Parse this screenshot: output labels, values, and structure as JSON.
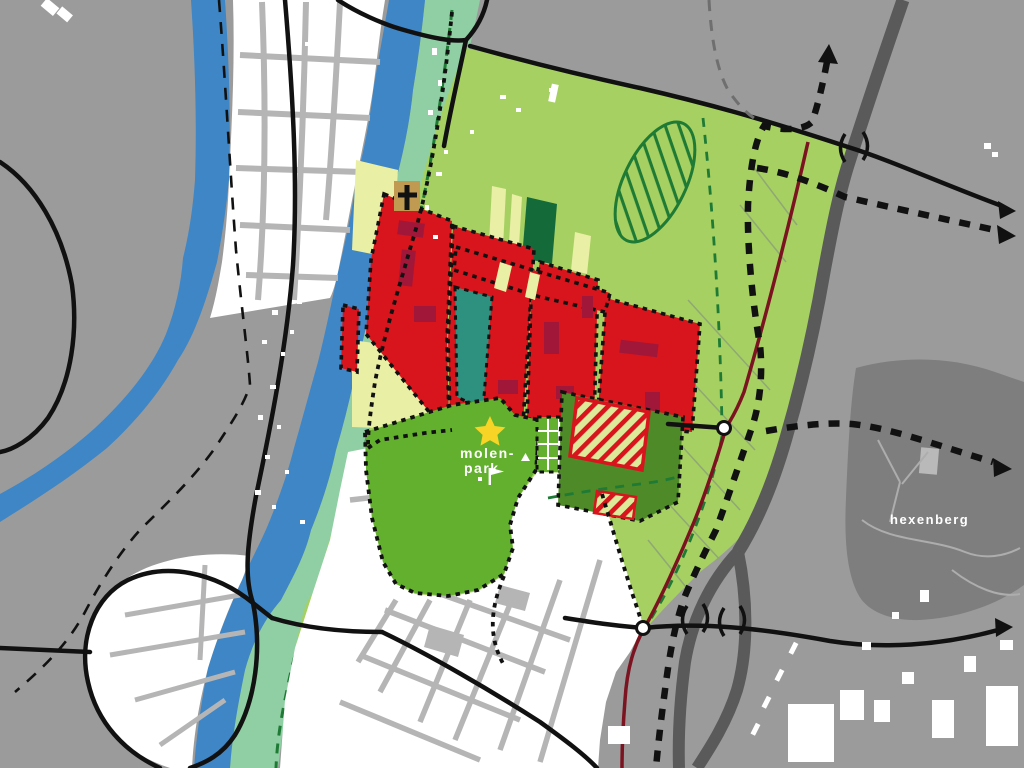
{
  "map": {
    "labels": {
      "park_line1": "molen-",
      "park_line2": "park",
      "hill": "hexenberg"
    },
    "colors": {
      "background": "#9b9b9b",
      "water": "#3e86c6",
      "riverside_band": "#8fcfa3",
      "plan_area": "#a6d061",
      "park": "#63b02e",
      "sports_field": "#4e8a28",
      "forest": "#156a3a",
      "teal_parcel": "#2e9180",
      "pale_field": "#e9efa5",
      "development": "#d8141c",
      "development_dark": "#a0173a",
      "hatch_bg": "#dcea9a",
      "hatch_stripe": "#d8141c",
      "boundary_dots": "#111111",
      "route_dashes": "#111111",
      "green_dashed": "#1e7a34",
      "maroon_road": "#7b1420",
      "highway": "#5a5a5a",
      "road": "#111111",
      "street": "#b5b5b5",
      "buildings": "#ffffff",
      "hill": "#7e7e7e",
      "hill_paths": "#adadad",
      "hill_tab": "#b9b9b9",
      "church": "#c09a50",
      "cross": "#111111",
      "star": "#f7d426",
      "node_fill": "#ffffff",
      "grid_lines": "#ffffff",
      "field_lines": "#8fa876",
      "gray_dash": "#6f6f6f",
      "label_text": "#ffffff"
    }
  }
}
